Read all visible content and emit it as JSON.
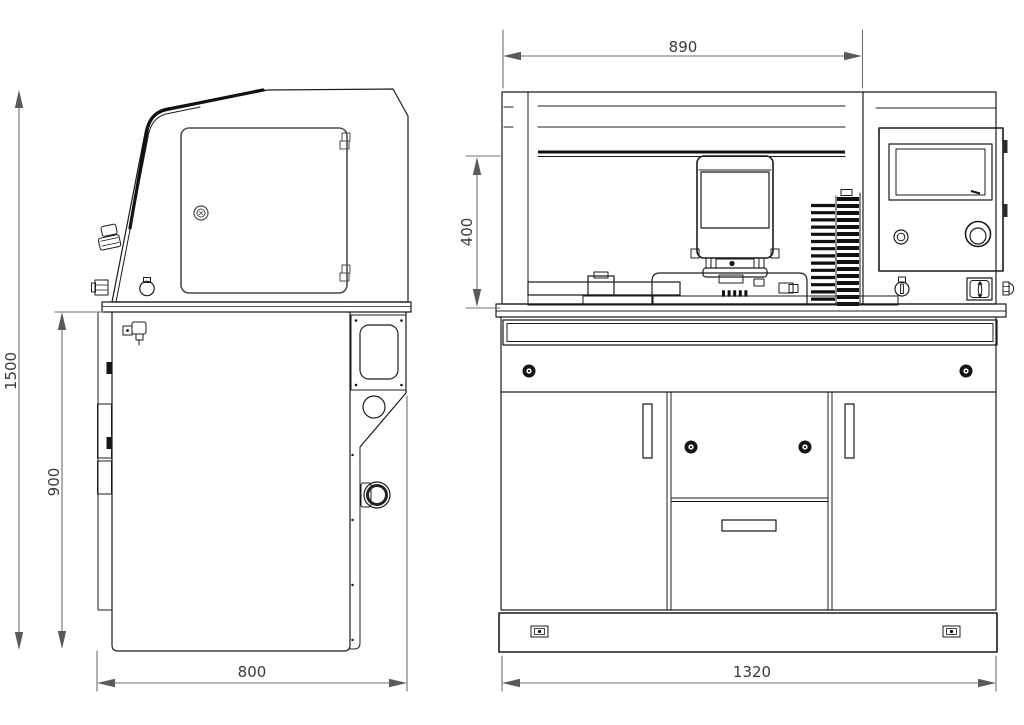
{
  "title": "machine-dimension-drawing",
  "colors": {
    "background": "#ffffff",
    "outline": "#1c1c1c",
    "dimension_line": "#6f6f6f",
    "dimension_text": "#3a3a3a"
  },
  "views": {
    "side": {
      "name": "side-view",
      "dimensions": {
        "overall_height_mm": "1500",
        "base_cabinet_height_mm": "900",
        "depth_mm": "800"
      }
    },
    "front": {
      "name": "front-view",
      "dimensions": {
        "enclosure_width_mm": "890",
        "work_chamber_height_mm": "400",
        "overall_width_mm": "1320"
      }
    }
  }
}
